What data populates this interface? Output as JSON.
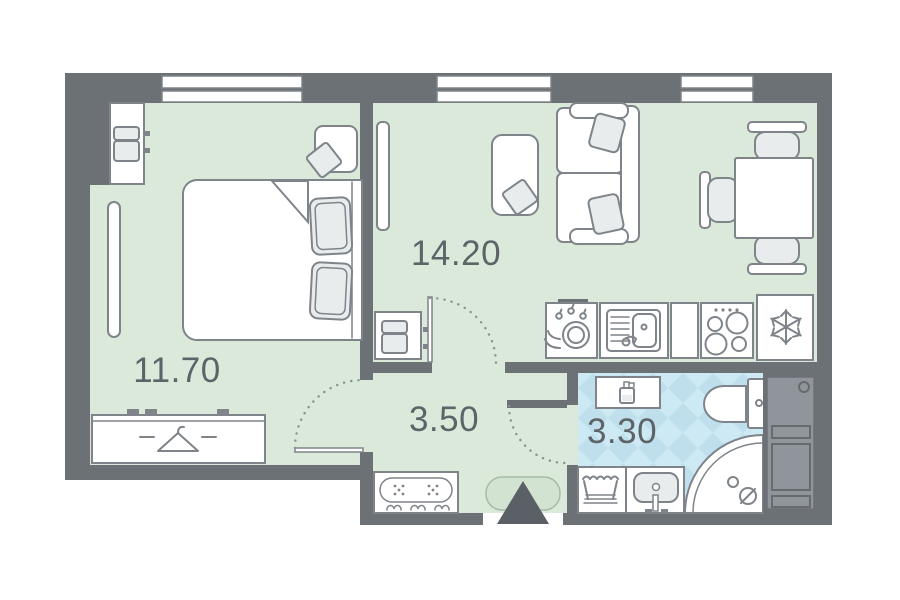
{
  "plan": {
    "type": "apartment-floor-plan",
    "rooms": [
      {
        "name": "bedroom",
        "area_label": "11.70"
      },
      {
        "name": "living-kitchen",
        "area_label": "14.20"
      },
      {
        "name": "hallway",
        "area_label": "3.50"
      },
      {
        "name": "bathroom",
        "area_label": "3.30"
      }
    ],
    "colors": {
      "wall": "#6c7176",
      "room_floor": "#dbe9da",
      "bathroom_tile_light": "#cde9f3",
      "bathroom_tile_dark": "#bfdfec",
      "furniture_outline": "#7e8489",
      "label_text": "#5d6468",
      "entrance_marker": "#5a6065",
      "entrance_pad_fill": "#d3e3d2"
    },
    "icons": [
      "hanger-icon",
      "snowflake-icon",
      "cooktop-icon",
      "dish-drying-icon",
      "kitchen-sink-icon",
      "soap-dispenser-icon",
      "laundry-basket-icon",
      "toilet-icon",
      "shower-icon",
      "washbasin-icon",
      "entrance-arrow-icon",
      "door-swing-arc",
      "coat-hooks-icon"
    ]
  }
}
